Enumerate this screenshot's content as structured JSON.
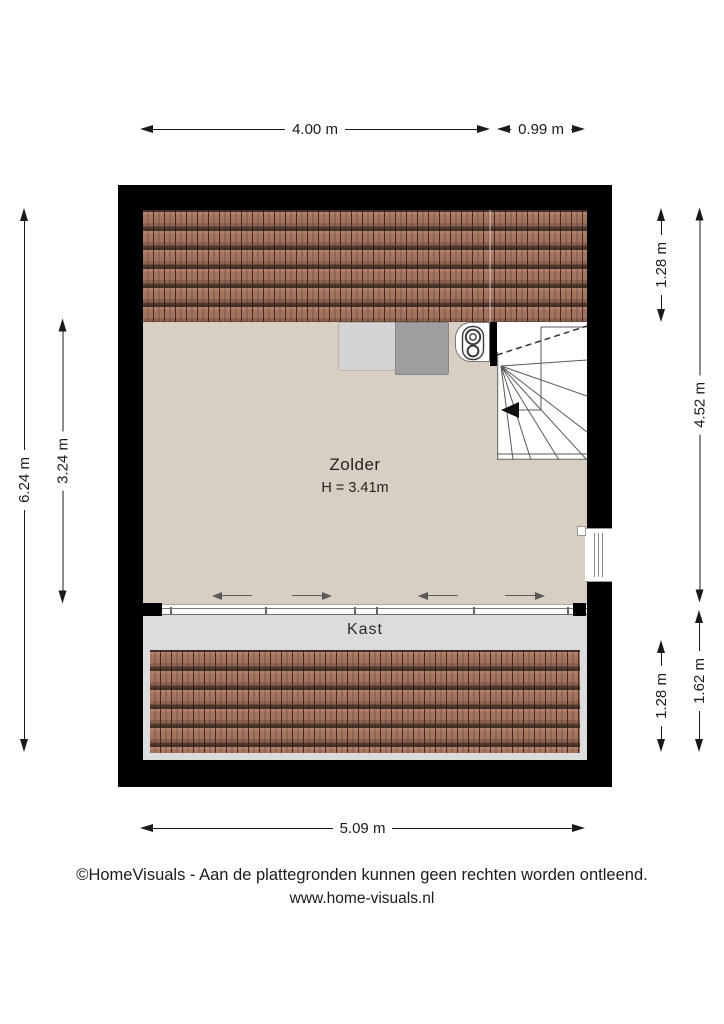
{
  "plan": {
    "room": {
      "name": "Zolder",
      "height_label": "H = 3.41m"
    },
    "closet": {
      "name": "Kast"
    },
    "features": [
      "roof-slope-top",
      "roof-slope-bottom",
      "stairs",
      "boiler",
      "washer",
      "dryer",
      "sliding-door-closet",
      "window-right-wall"
    ]
  },
  "dimensions": {
    "top_room_width": "4.00 m",
    "top_stairs_width": "0.99 m",
    "left_total_depth": "6.24 m",
    "left_room_depth": "3.24 m",
    "right_roof_top": "1.28 m",
    "right_room_height": "4.52 m",
    "right_roof_bottom": "1.28 m",
    "right_closet_depth": "1.62 m",
    "bottom_total_width": "5.09 m"
  },
  "footer": {
    "copyright": "©HomeVisuals - Aan de plattegronden kunnen geen rechten worden ontleend.",
    "website": "www.home-visuals.nl"
  },
  "colors": {
    "wall": "#000000",
    "floor": "#d8cec2",
    "roof_tile": "#a5745f",
    "roof_tile_line": "#433026",
    "closet_floor": "#dcdcdc",
    "appliance_light": "#d4d4d4",
    "appliance_dark": "#9e9e9e",
    "dimension_text": "#1a1a1a"
  }
}
